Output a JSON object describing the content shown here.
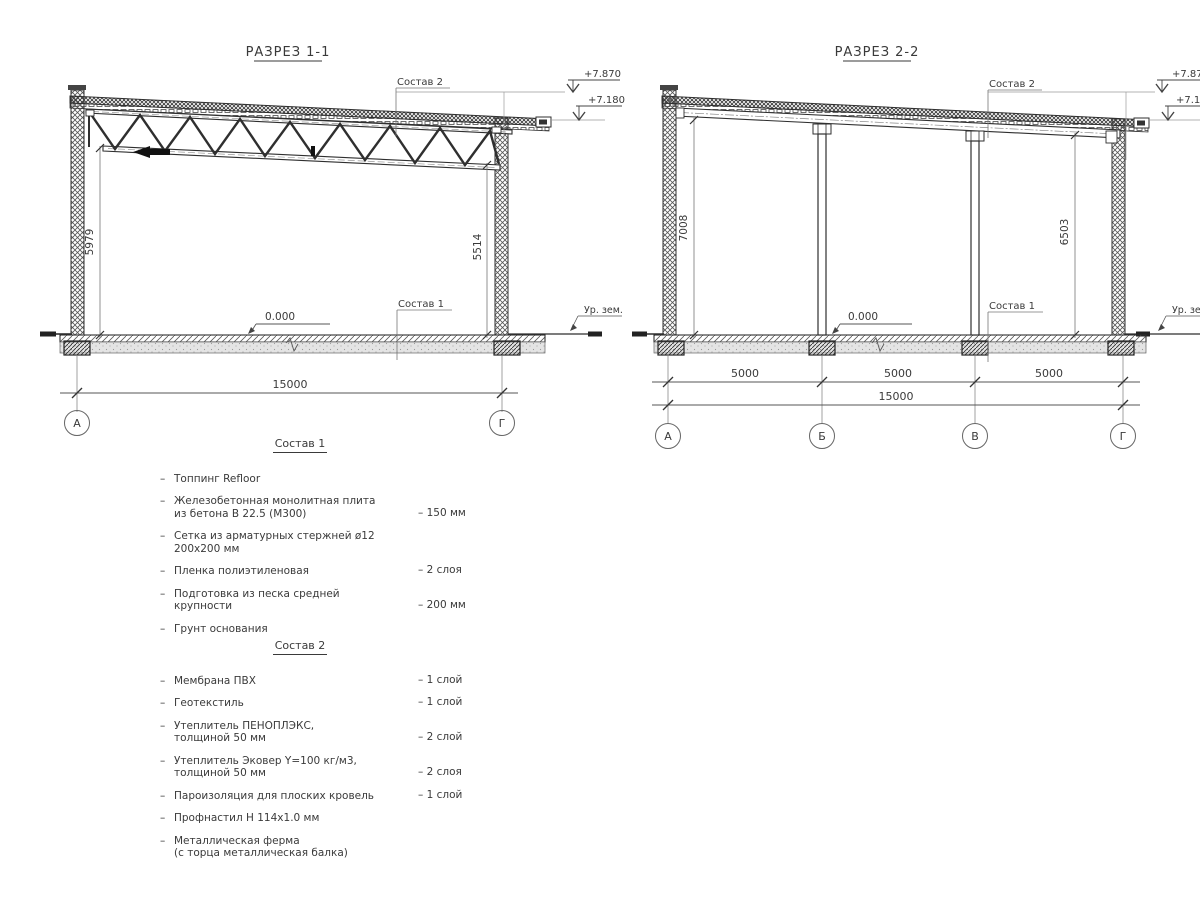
{
  "sections": [
    {
      "title": "РАЗРЕЗ 1-1",
      "elev_high": "+7.870",
      "elev_low": "+7.180",
      "height_left": "5979",
      "height_right": "5514",
      "total_width": "15000",
      "zero_level": "0.000",
      "ground_level_label": "Ур. зем.",
      "roof_callout": "Состав 2",
      "floor_callout": "Состав 1",
      "axes": [
        "А",
        "Г"
      ]
    },
    {
      "title": "РАЗРЕЗ 2-2",
      "elev_high": "+7.870",
      "elev_low": "+7.180",
      "height_left": "7008",
      "height_right": "6503",
      "bay_widths": [
        "5000",
        "5000",
        "5000"
      ],
      "total_width": "15000",
      "zero_level": "0.000",
      "ground_level_label": "Ур. зем.",
      "roof_callout": "Состав 2",
      "floor_callout": "Состав 1",
      "axes": [
        "А",
        "Б",
        "В",
        "Г"
      ]
    }
  ],
  "composition_lists": [
    {
      "heading": "Состав 1",
      "items": [
        {
          "lines": [
            "Топпинг Refloor"
          ],
          "value": ""
        },
        {
          "lines": [
            "Железобетонная  монолитная плита",
            "из бетона В 22.5 (М300)"
          ],
          "value": "– 150 мм"
        },
        {
          "lines": [
            "Сетка из арматурных стержней ø12 200х200 мм"
          ],
          "value": ""
        },
        {
          "lines": [
            "Пленка полиэтиленовая"
          ],
          "value": "– 2 слоя"
        },
        {
          "lines": [
            "Подготовка из песка средней",
            "крупности"
          ],
          "value": "– 200 мм"
        },
        {
          "lines": [
            "Грунт основания"
          ],
          "value": ""
        }
      ]
    },
    {
      "heading": "Состав 2",
      "items": [
        {
          "lines": [
            "Мембрана ПВХ"
          ],
          "value": "– 1 слой"
        },
        {
          "lines": [
            "Геотекстиль"
          ],
          "value": "– 1 слой"
        },
        {
          "lines": [
            "Утеплитель ПЕНОПЛЭКС,",
            "толщиной 50 мм"
          ],
          "value": "– 2 слой"
        },
        {
          "lines": [
            "Утеплитель Эковер Y=100 кг/м3,",
            "толщиной 50 мм"
          ],
          "value": "– 2 слоя"
        },
        {
          "lines": [
            "Пароизоляция для плоских кровель"
          ],
          "value": "– 1 слой"
        },
        {
          "lines": [
            "Профнастил Н 114х1.0 мм"
          ],
          "value": ""
        },
        {
          "lines": [
            "Металлическая ферма",
            "(с торца металлическая балка)"
          ],
          "value": ""
        }
      ]
    }
  ],
  "colors": {
    "line": "#2f2f2f",
    "thin": "#8a8a8a",
    "text": "#3a3a3a",
    "sand": "#e4e4e4"
  }
}
